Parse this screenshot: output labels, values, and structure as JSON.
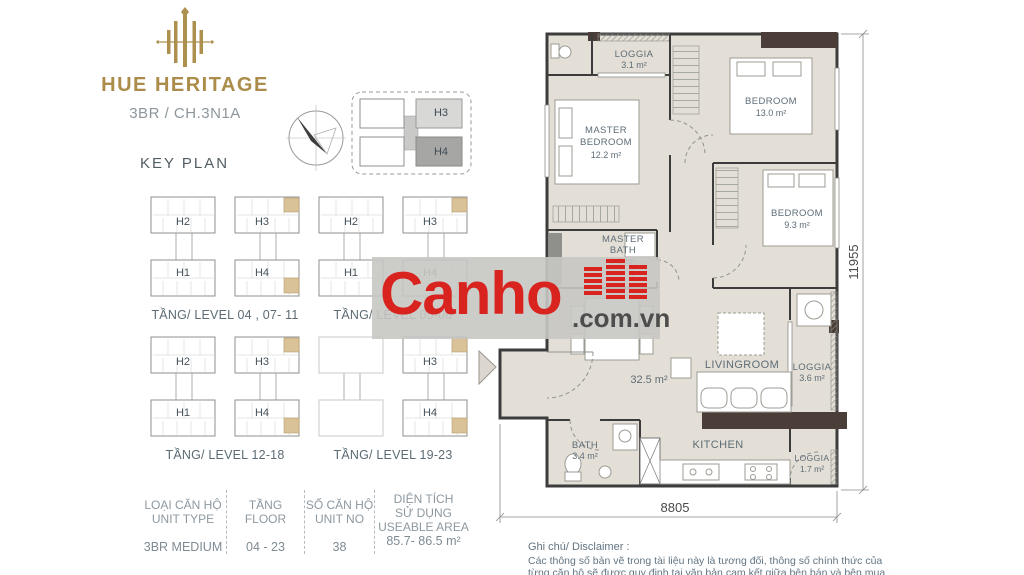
{
  "brand": {
    "name": "HUE HERITAGE",
    "unit_code": "3BR / CH.3N1A"
  },
  "key_plan": {
    "title": "KEY PLAN",
    "mini": {
      "h3": "H3",
      "h4": "H4"
    },
    "groups": [
      {
        "h2": "H2",
        "h3": "H3",
        "h1": "H1",
        "h4": "H4",
        "caption": "TẦNG/ LEVEL 04 , 07- 11"
      },
      {
        "h2": "H2",
        "h3": "H3",
        "h1": "H1",
        "h4": "H4",
        "caption": "TẦNG/ LEVEL 05-06"
      },
      {
        "h2": "H2",
        "h3": "H3",
        "h1": "H1",
        "h4": "H4",
        "caption": "TẦNG/ LEVEL 12-18"
      },
      {
        "h3": "H3",
        "h4": "H4",
        "caption": "TẦNG/ LEVEL 19-23"
      }
    ]
  },
  "table": {
    "col1": {
      "vi": "LOẠI CĂN HỘ",
      "en": "UNIT TYPE",
      "value": "3BR MEDIUM"
    },
    "col2": {
      "vi": "TẦNG",
      "en": "FLOOR",
      "value": "04 - 23"
    },
    "col3": {
      "vi": "SỐ CĂN HỘ",
      "en": "UNIT NO",
      "value": "38"
    },
    "col4": {
      "vi1": "DIỆN TÍCH",
      "vi2": "SỬ DỤNG",
      "en": "USEABLE AREA",
      "value": "85.7- 86.5 m²"
    }
  },
  "plan": {
    "loggia_top": {
      "name": "LOGGIA",
      "area": "3.1 m²"
    },
    "master_bedroom": {
      "l1": "MASTER",
      "l2": "BEDROOM",
      "area": "12.2 m²"
    },
    "bedroom_13": {
      "name": "BEDROOM",
      "area": "13.0 m²"
    },
    "bedroom_9": {
      "name": "BEDROOM",
      "area": "9.3 m²"
    },
    "master_bath": {
      "l1": "MASTER",
      "l2": "BATH",
      "area": "3.3 m²"
    },
    "central_area": "32.5 m²",
    "livingroom": "LIVINGROOM",
    "loggia_right": {
      "name": "LOGGIA",
      "area": "3.6 m²"
    },
    "bath": {
      "name": "BATH",
      "area": "3.4 m²"
    },
    "kitchen": "KITCHEN",
    "loggia_bottom": {
      "name": "LOGGIA",
      "area": "1.7 m²"
    },
    "dim_width": "8805",
    "dim_height": "11955"
  },
  "watermark": {
    "name": "Canho",
    "domain": ".com.vn",
    "red": "#d8231f"
  },
  "disclaimer": {
    "title": "Ghi chú/ Disclaimer :",
    "line1": "Các thông số bản vẽ trong tài liệu này là tương đối, thông số  chính thức của",
    "line2": "từng căn hộ sẽ được quy định tại văn bản cam kết giữa bên bán và bên mua ."
  }
}
